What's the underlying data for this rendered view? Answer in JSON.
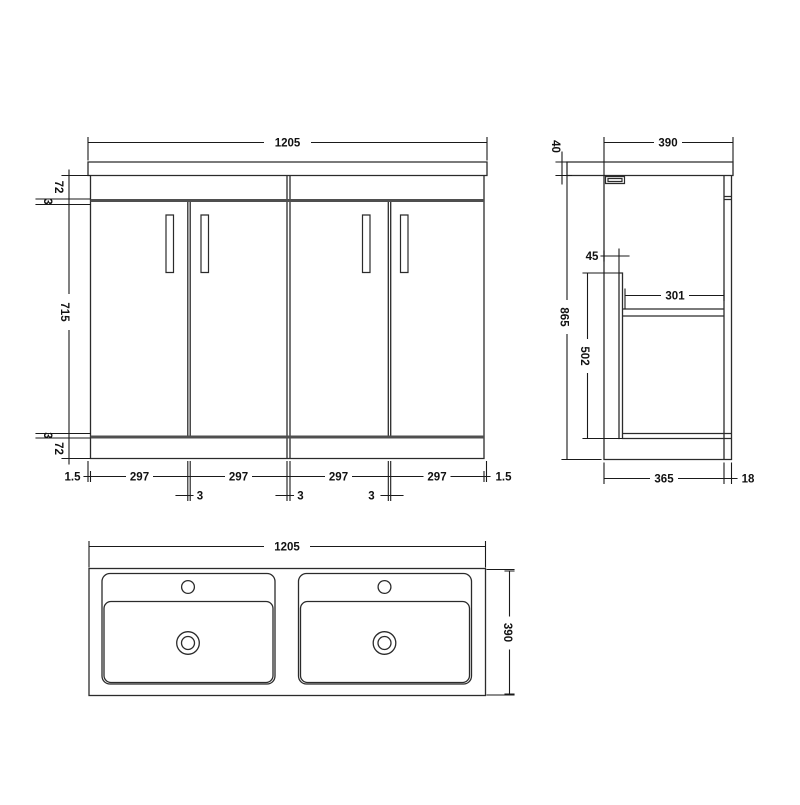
{
  "drawing": {
    "description": "Technical dimension drawing of a 4-door double-basin bathroom vanity unit",
    "units": "mm"
  },
  "front_view": {
    "width": "1205",
    "top_rail": "72",
    "gap_top": "3",
    "door_height": "715",
    "gap_bottom": "3",
    "plinth": "72",
    "edge_left": "1.5",
    "edge_right": "1.5",
    "door_widths": [
      "297",
      "297",
      "297",
      "297"
    ],
    "door_gaps": [
      "3",
      "3",
      "3"
    ]
  },
  "side_view": {
    "depth": "390",
    "worktop_thickness": "40",
    "overall_height": "865",
    "front_clearance": "45",
    "shelf_depth": "301",
    "internal_height": "502",
    "cabinet_depth": "365",
    "back_panel": "18"
  },
  "plan_view": {
    "width": "1205",
    "depth": "390"
  }
}
